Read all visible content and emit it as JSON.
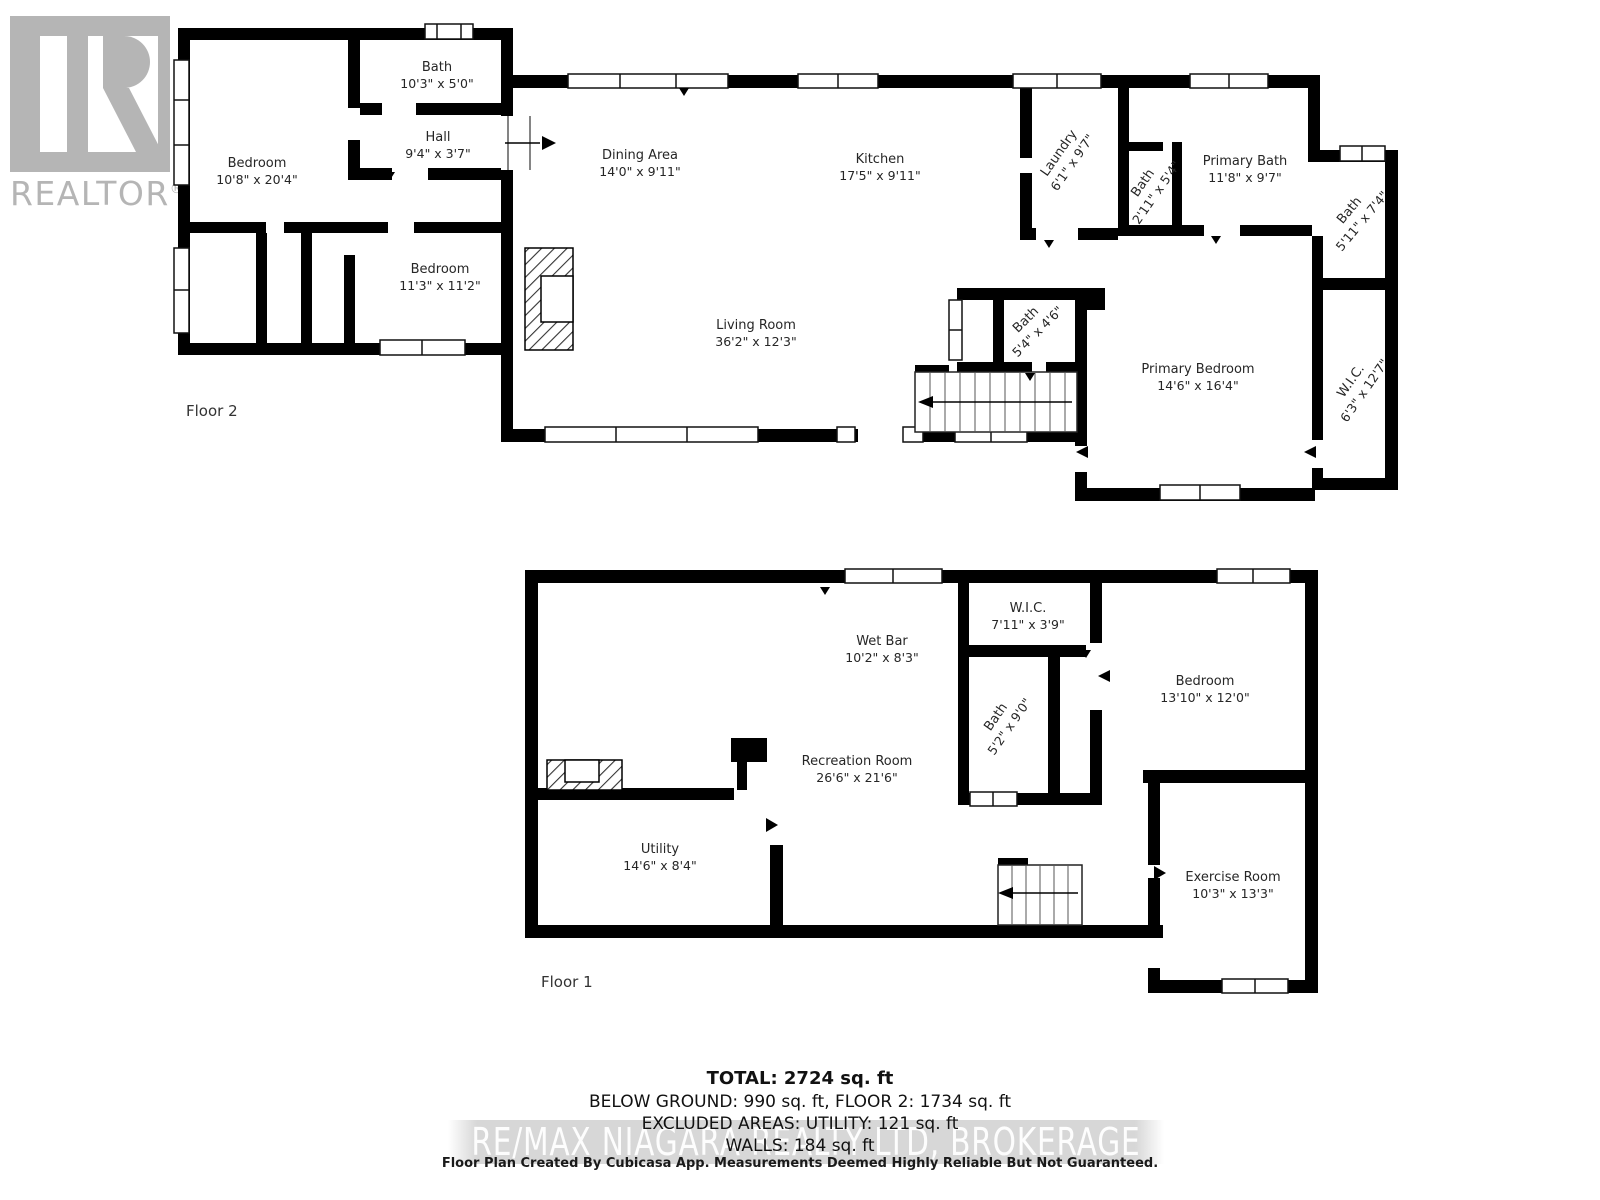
{
  "logo": {
    "text": "REALTOR",
    "registered": "®"
  },
  "floors": [
    {
      "label": {
        "text": "Floor 2",
        "x": 186,
        "y": 402
      },
      "rooms": [
        {
          "id": "bedroom-1-f2",
          "name": "Bedroom",
          "dims": "10'8\" x 20'4\"",
          "x": 257,
          "y": 172,
          "rot": 0
        },
        {
          "id": "bath-top-f2",
          "name": "Bath",
          "dims": "10'3\" x 5'0\"",
          "x": 437,
          "y": 76,
          "rot": 0
        },
        {
          "id": "hall-f2",
          "name": "Hall",
          "dims": "9'4\" x 3'7\"",
          "x": 438,
          "y": 146,
          "rot": 0
        },
        {
          "id": "bedroom-2-f2",
          "name": "Bedroom",
          "dims": "11'3\" x 11'2\"",
          "x": 440,
          "y": 278,
          "rot": 0
        },
        {
          "id": "dining-area-f2",
          "name": "Dining Area",
          "dims": "14'0\" x 9'11\"",
          "x": 640,
          "y": 164,
          "rot": 0
        },
        {
          "id": "kitchen-f2",
          "name": "Kitchen",
          "dims": "17'5\" x 9'11\"",
          "x": 880,
          "y": 168,
          "rot": 0
        },
        {
          "id": "living-room-f2",
          "name": "Living Room",
          "dims": "36'2\" x 12'3\"",
          "x": 756,
          "y": 334,
          "rot": 0
        },
        {
          "id": "laundry-f2",
          "name": "Laundry",
          "dims": "6'1\" x 9'7\"",
          "x": 1066,
          "y": 158,
          "rot": -55
        },
        {
          "id": "bath-small-f2",
          "name": "Bath",
          "dims": "2'11\" x 5'4\"",
          "x": 1150,
          "y": 188,
          "rot": -55
        },
        {
          "id": "primary-bath-f2",
          "name": "Primary Bath",
          "dims": "11'8\" x 9'7\"",
          "x": 1245,
          "y": 170,
          "rot": 0
        },
        {
          "id": "bath-right-f2",
          "name": "Bath",
          "dims": "5'11\" x 7'4\"",
          "x": 1356,
          "y": 216,
          "rot": -50
        },
        {
          "id": "bath-stairs-f2",
          "name": "Bath",
          "dims": "5'4\" x 4'6\"",
          "x": 1032,
          "y": 326,
          "rot": -45
        },
        {
          "id": "primary-bedroom-f2",
          "name": "Primary Bedroom",
          "dims": "14'6\" x 16'4\"",
          "x": 1198,
          "y": 378,
          "rot": 0
        },
        {
          "id": "wic-f2",
          "name": "W.I.C.",
          "dims": "6'3\" x 12'7\"",
          "x": 1358,
          "y": 386,
          "rot": -55
        }
      ]
    },
    {
      "label": {
        "text": "Floor 1",
        "x": 541,
        "y": 973
      },
      "rooms": [
        {
          "id": "wet-bar-f1",
          "name": "Wet Bar",
          "dims": "10'2\" x 8'3\"",
          "x": 882,
          "y": 650,
          "rot": 0
        },
        {
          "id": "wic-f1",
          "name": "W.I.C.",
          "dims": "7'11\" x 3'9\"",
          "x": 1028,
          "y": 617,
          "rot": 0
        },
        {
          "id": "bath-f1",
          "name": "Bath",
          "dims": "5'2\" x 9'0\"",
          "x": 1003,
          "y": 722,
          "rot": -55
        },
        {
          "id": "bedroom-f1",
          "name": "Bedroom",
          "dims": "13'10\" x 12'0\"",
          "x": 1205,
          "y": 690,
          "rot": 0
        },
        {
          "id": "recreation-room-f1",
          "name": "Recreation Room",
          "dims": "26'6\" x 21'6\"",
          "x": 857,
          "y": 770,
          "rot": 0
        },
        {
          "id": "utility-f1",
          "name": "Utility",
          "dims": "14'6\" x 8'4\"",
          "x": 660,
          "y": 858,
          "rot": 0
        },
        {
          "id": "exercise-room-f1",
          "name": "Exercise Room",
          "dims": "10'3\" x 13'3\"",
          "x": 1233,
          "y": 886,
          "rot": 0
        }
      ]
    }
  ],
  "summary": {
    "total": "TOTAL: 2724 sq. ft",
    "line2": "BELOW GROUND: 990 sq. ft, FLOOR 2: 1734 sq. ft",
    "line3": "EXCLUDED AREAS: UTILITY: 121 sq. ft",
    "line4": "WALLS: 184 sq. ft"
  },
  "watermark": "RE/MAX NIAGARA REALTY LTD, BROKERAGE",
  "footer": "Floor Plan Created By Cubicasa App. Measurements Deemed Highly Reliable But Not Guaranteed."
}
